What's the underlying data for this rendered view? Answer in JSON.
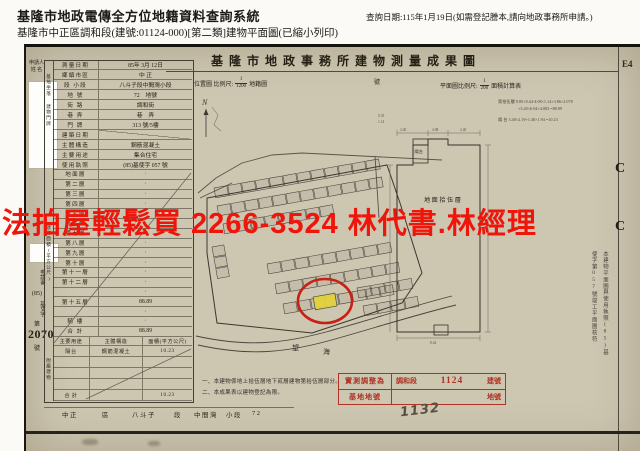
{
  "header": {
    "system_title": "基隆市地政電傳全方位地籍資料查詢系統",
    "query_date": "查詢日期:115年1月19日(如需登記謄本,請向地政事務所申請。)",
    "subtitle": "基隆市中正區調和段(建號:01124-000)[第二類]建物平面圖(已縮小列印)"
  },
  "doc": {
    "title": "基隆市地政事務所建物測量成果圖",
    "sheet_code": "E4",
    "location_scale_label": "位置圖 比例尺:",
    "location_scale_num": "1",
    "location_scale_den": "1200",
    "location_scale_suffix": "地籍圖",
    "building_no_label": "號",
    "plan_scale_label": "平面圖比例尺:",
    "plan_scale_num": "1",
    "plan_scale_den": "200",
    "plan_scale_suffix": "面積計算表",
    "calc": {
      "line1": "第拾伍層  8.85×8.44-4.08×1.14+3.86×2.078",
      "line2": "+3.20×6.04+4.083 =88.89",
      "line3": "陽 台  3.40×2.19+1.40×1.94 =10.23"
    },
    "side_note": "本建物平面圖與使用執照(85)基使字第057號竣工平面圖核符",
    "orientation_mark": "C",
    "handwriting": "1132",
    "plan_dims": {
      "top1": "2.40",
      "top2": "4.08",
      "top3": "2.40",
      "right": "8.85",
      "left": "14.20",
      "bottom": "8.44",
      "micro1": "0.35",
      "micro2": "1.14"
    }
  },
  "applicant": {
    "label_line1": "申請人",
    "label_line2": "姓 名"
  },
  "application_no": {
    "prefix": "申請書",
    "year": "(85)",
    "word": "基丈字",
    "no_label": "第",
    "number": "2070",
    "suffix": "號"
  },
  "table": {
    "group_base": "基地坐落",
    "group_door": "建物門牌",
    "floors_group_label": "建物面積(平方公尺)",
    "attachment_group_label": "附屬建物",
    "rows": [
      {
        "label": "測量日期",
        "value": "85年 3月 12日"
      },
      {
        "label": "鄉鎮市區",
        "value": "中 正"
      },
      {
        "label": "段 小段",
        "value": "八斗子段中間灣小段"
      },
      {
        "label": "地 號",
        "value": "72　地號"
      },
      {
        "label": "街 路",
        "value": "調和街"
      },
      {
        "label": "巷 弄",
        "value": "巷　弄"
      },
      {
        "label": "門 牌",
        "value": "313 號/5樓"
      },
      {
        "label": "建築日期",
        "value": "",
        "diag": true
      },
      {
        "label": "主體構造",
        "value": "鋼筋混凝土"
      },
      {
        "label": "主要用途",
        "value": "集合住宅"
      },
      {
        "label": "使用執照",
        "value": "(85)基使字 057 號"
      }
    ],
    "floors": [
      [
        "地面層",
        "·"
      ],
      [
        "第二層",
        "·"
      ],
      [
        "第三層",
        "·"
      ],
      [
        "第四層",
        "·"
      ],
      [
        "第五層",
        "·"
      ],
      [
        "第六層",
        "·"
      ],
      [
        "第七層",
        "·"
      ],
      [
        "第八層",
        "·"
      ],
      [
        "第九層",
        "·"
      ],
      [
        "第十層",
        "·"
      ],
      [
        "第十一層",
        "·"
      ],
      [
        "第十二層",
        "·"
      ],
      [
        "",
        "·"
      ],
      [
        "第十五層",
        "88.89"
      ],
      [
        "",
        "·"
      ],
      [
        "騎 樓",
        "·"
      ],
      [
        "合 計",
        "88.89"
      ]
    ],
    "attachment_headers": [
      "主要用途",
      "主體構造",
      "面積(平方公尺)"
    ],
    "attachment_rows": [
      [
        "陽台",
        "鋼筋混凝土",
        "10.23"
      ],
      [
        "",
        "",
        ""
      ],
      [
        "",
        "",
        ""
      ],
      [
        "",
        "",
        ""
      ],
      [
        "合 計",
        "",
        "10.23"
      ]
    ]
  },
  "footer_row": {
    "items": [
      "中正",
      "區",
      "八斗子",
      "段",
      "中間灣",
      "小段",
      "72"
    ]
  },
  "notes": {
    "line1": "一、本建物係地上拾伍層地下貳層建物第拾伍層部分。",
    "line2": "二、本成果表以建物登記為限。"
  },
  "stamp": {
    "row1_label": "實測調整為",
    "row1_section": "調和段",
    "row1_number": "1124",
    "row1_unit": "建號",
    "row2_label": "基地地號",
    "row2_unit": "地號",
    "color": "#b03224"
  },
  "map": {
    "north_label": "N",
    "road_label_1": "望",
    "road_label_2": "海",
    "plan_label": "地面拾伍層",
    "balcony_label": "陽台",
    "highlight_color": "#e4d23f",
    "circle_color": "#c82015"
  },
  "watermark": {
    "text": "法拍屋輕鬆買 2266-3524 林代書.林經理",
    "color": "#ef150a"
  }
}
